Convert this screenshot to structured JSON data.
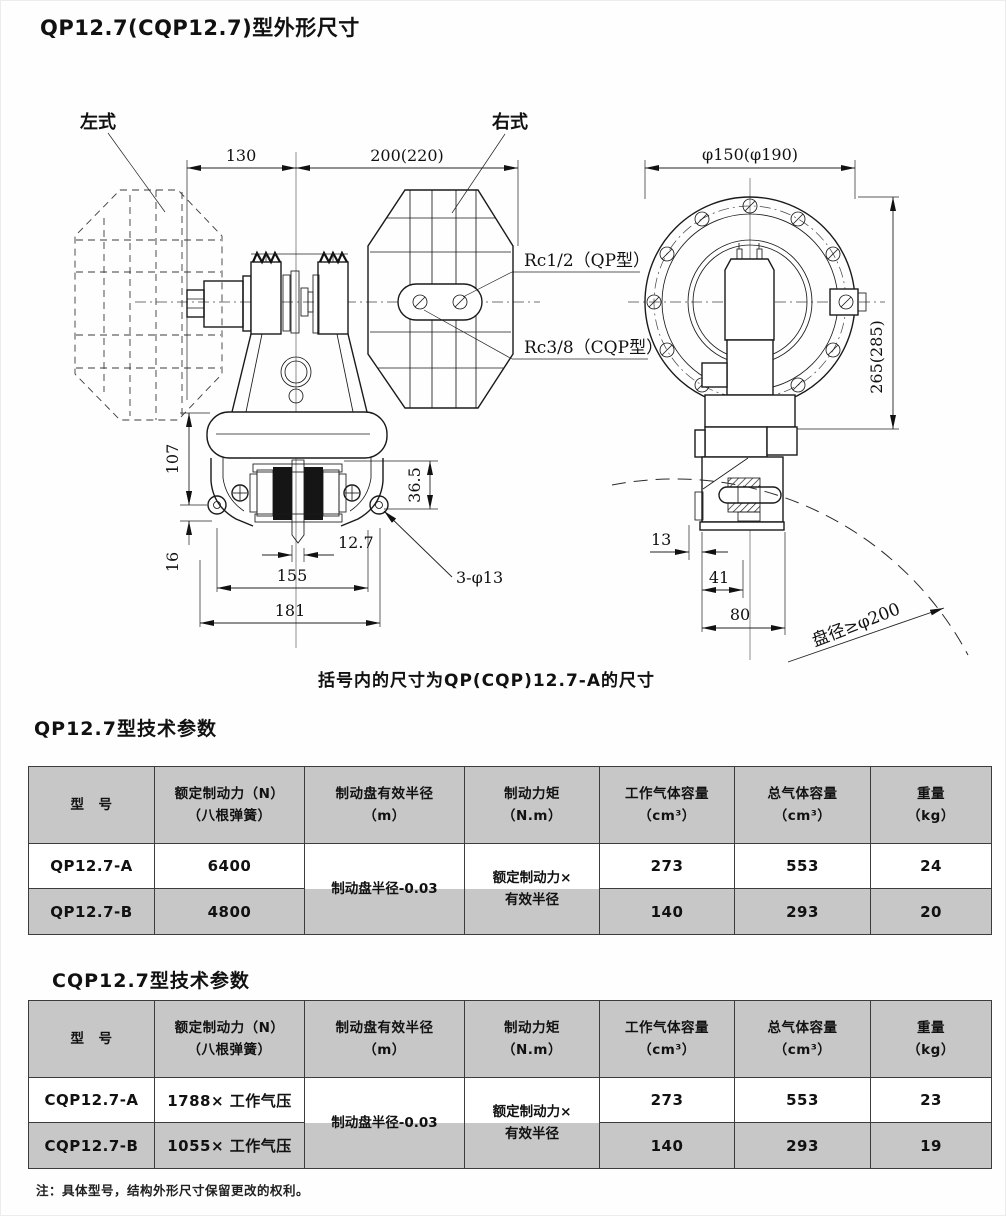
{
  "page": {
    "title": "QP12.7(CQP12.7)型外形尺寸",
    "caption": "括号内的尺寸为QP(CQP)12.7-A的尺寸",
    "footnote": "注：具体型号，结构外形尺寸保留更改的权利。"
  },
  "drawing": {
    "view_labels": {
      "left": "左式",
      "right": "右式"
    },
    "port_labels": {
      "qp": "Rc1/2（QP型）",
      "cqp": "Rc3/8（CQP型）"
    },
    "disc_label": "盘径≥φ200",
    "dims": {
      "width_left": "130",
      "width_right": "200(220)",
      "flange_dia": "φ150(φ190)",
      "height_side": "265(285)",
      "h107": "107",
      "h36_5": "36.5",
      "h16": "16",
      "slot": "12.7",
      "w155": "155",
      "w181": "181",
      "holes": "3-φ13",
      "d13": "13",
      "d41": "41",
      "d80": "80"
    }
  },
  "tables": [
    {
      "title": "QP12.7型技术参数",
      "headers": [
        {
          "l1": "型　号",
          "l2": ""
        },
        {
          "l1": "额定制动力（N）",
          "l2": "（八根弹簧）"
        },
        {
          "l1": "制动盘有效半径",
          "l2": "（m）"
        },
        {
          "l1": "制动力矩",
          "l2": "（N.m）"
        },
        {
          "l1": "工作气体容量",
          "l2": "（cm³）"
        },
        {
          "l1": "总气体容量",
          "l2": "（cm³）"
        },
        {
          "l1": "重量",
          "l2": "（kg）"
        }
      ],
      "merged": {
        "radius": "制动盘半径-0.03",
        "torque_l1": "额定制动力×",
        "torque_l2": "有效半径"
      },
      "rows": [
        {
          "model": "QP12.7-A",
          "force": "6400",
          "work_vol": "273",
          "total_vol": "553",
          "weight": "24"
        },
        {
          "model": "QP12.7-B",
          "force": "4800",
          "work_vol": "140",
          "total_vol": "293",
          "weight": "20"
        }
      ]
    },
    {
      "title": "CQP12.7型技术参数",
      "headers": [
        {
          "l1": "型　号",
          "l2": ""
        },
        {
          "l1": "额定制动力（N）",
          "l2": "（八根弹簧）"
        },
        {
          "l1": "制动盘有效半径",
          "l2": "（m）"
        },
        {
          "l1": "制动力矩",
          "l2": "（N.m）"
        },
        {
          "l1": "工作气体容量",
          "l2": "（cm³）"
        },
        {
          "l1": "总气体容量",
          "l2": "（cm³）"
        },
        {
          "l1": "重量",
          "l2": "（kg）"
        }
      ],
      "merged": {
        "radius": "制动盘半径-0.03",
        "torque_l1": "额定制动力×",
        "torque_l2": "有效半径"
      },
      "rows": [
        {
          "model": "CQP12.7-A",
          "force": "1788× 工作气压",
          "work_vol": "273",
          "total_vol": "553",
          "weight": "23"
        },
        {
          "model": "CQP12.7-B",
          "force": "1055× 工作气压",
          "work_vol": "140",
          "total_vol": "293",
          "weight": "19"
        }
      ]
    }
  ],
  "colors": {
    "table_header_bg": "#c7c7c7",
    "row_shaded_bg": "#c7c7c7",
    "line": "#1a1a1a"
  }
}
